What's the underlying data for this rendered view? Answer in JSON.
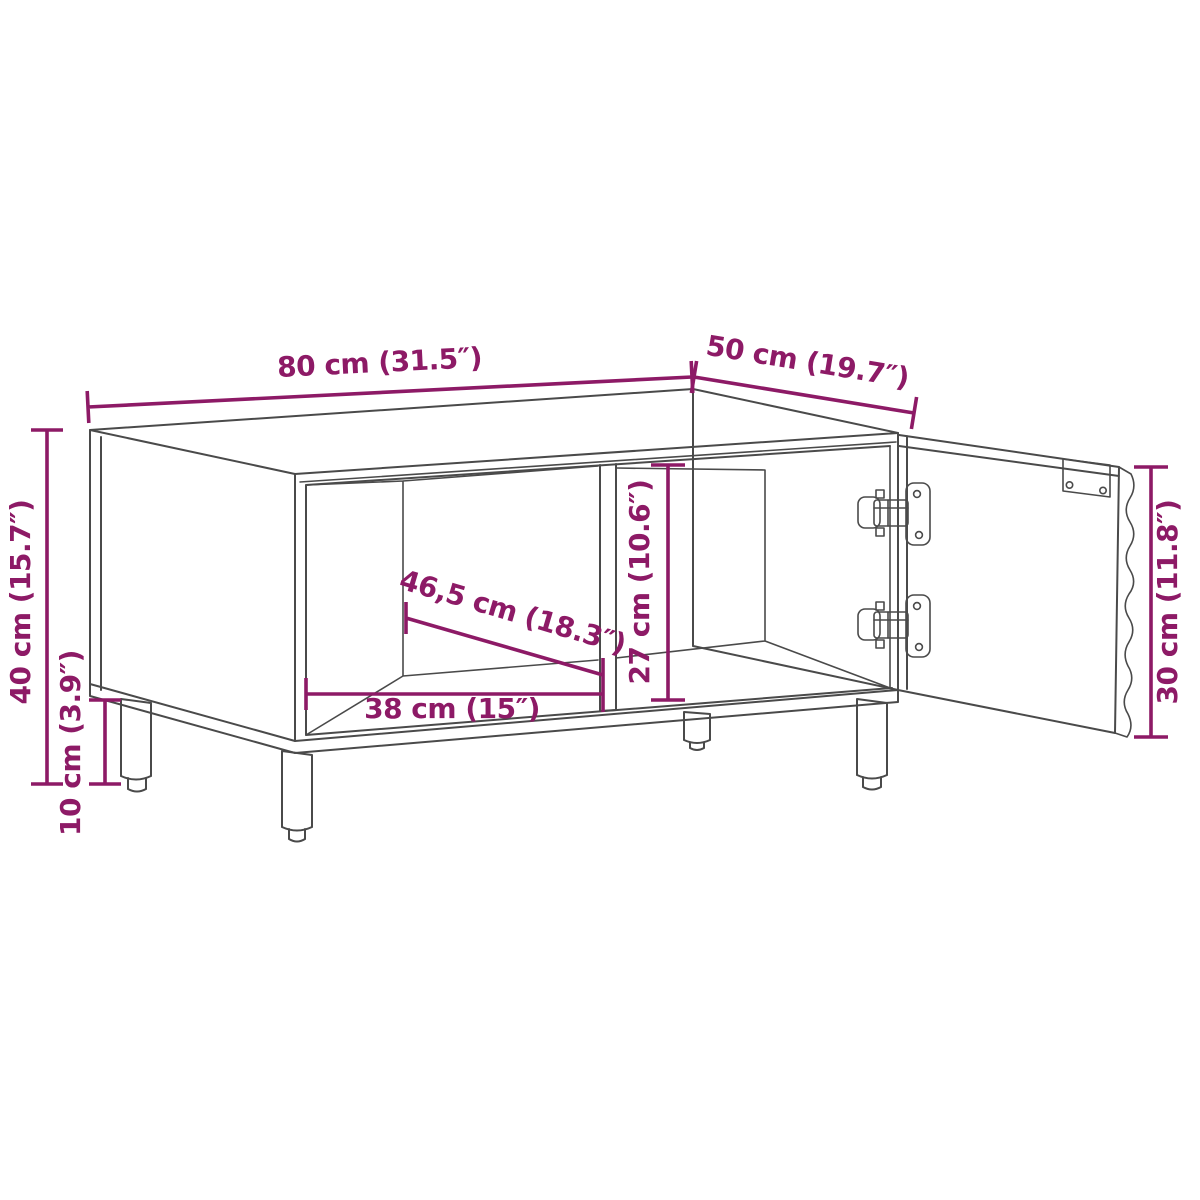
{
  "diagram": {
    "description": "Technical dimension drawing of a coffee table cabinet with two open shelf compartments, an open right-hand door with two concealed hinges, and four round legs",
    "colors": {
      "dimension_annotation": "#8D1A66",
      "outline": "#4A4A4A",
      "background": "#FFFFFF"
    },
    "dimensions": {
      "width": "80 cm (31.5″)",
      "depth": "50 cm (19.7″)",
      "height": "40 cm (15.7″)",
      "leg_height": "10 cm (3.9″)",
      "inner_diagonal": "46,5 cm (18.3″)",
      "inner_width": "38 cm (15″)",
      "inner_height": "27 cm (10.6″)",
      "door_height": "30 cm (11.8″)"
    }
  }
}
